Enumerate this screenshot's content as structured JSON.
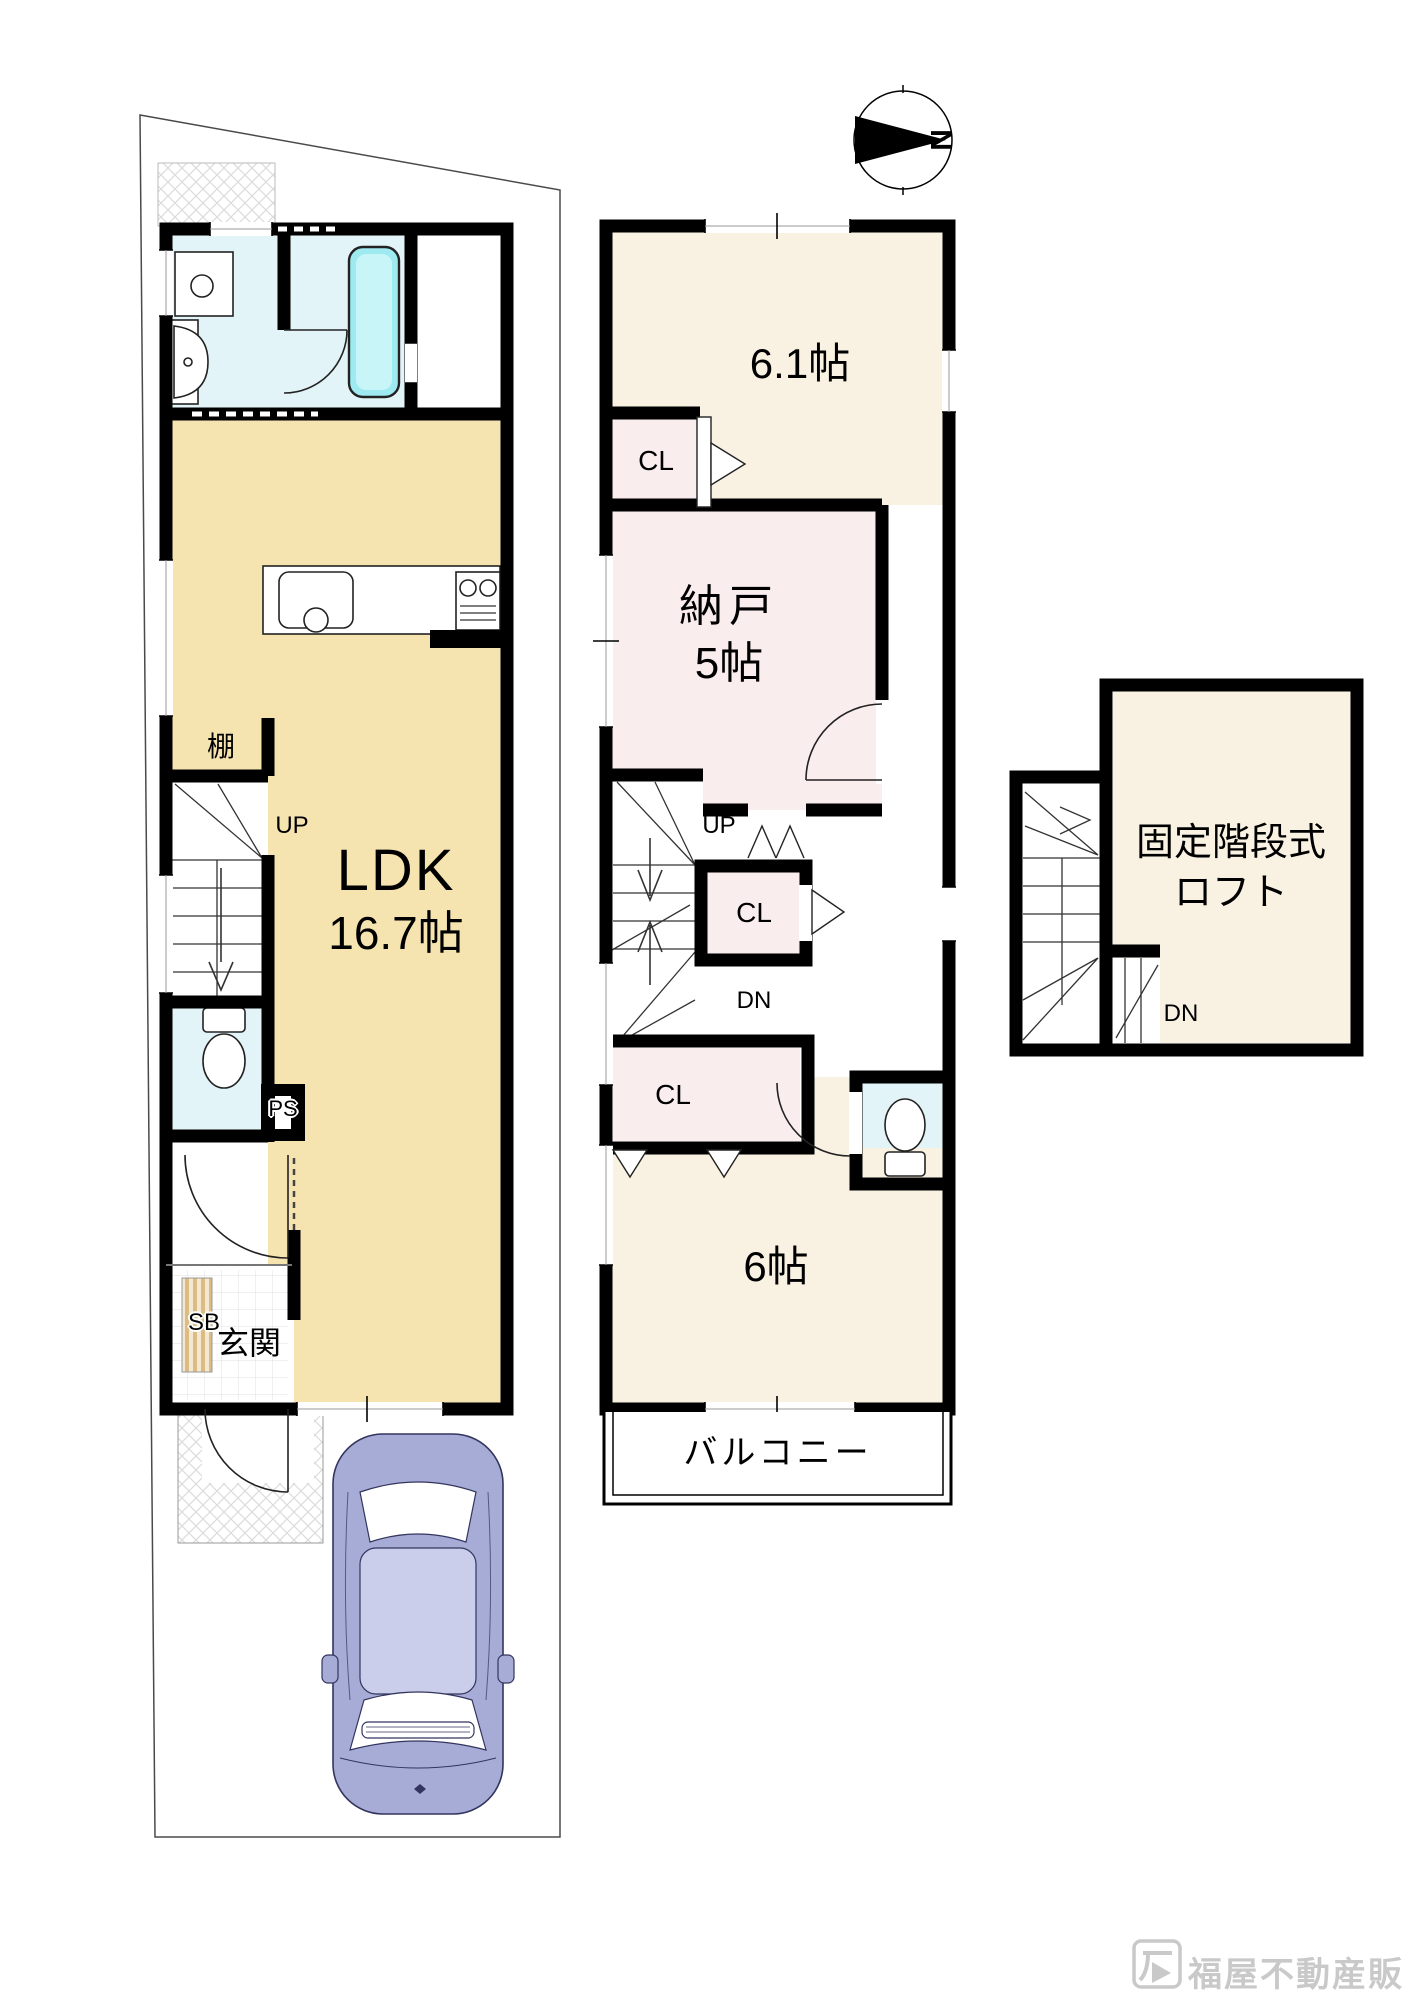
{
  "page": {
    "background": "#FFFFFF",
    "type": "floor-plan"
  },
  "compass": {
    "label": "N"
  },
  "floor1": {
    "rooms": {
      "ldk": {
        "label": "LDK",
        "size": "16.7帖"
      },
      "entrance": {
        "label": "玄関"
      },
      "shoe_box": {
        "label": "SB"
      },
      "pipe_space": {
        "label": "PS"
      },
      "shelf": {
        "label": "棚"
      },
      "stairs_up": {
        "label": "UP"
      }
    }
  },
  "floor2": {
    "rooms": {
      "room_6_1": {
        "label": "6.1帖"
      },
      "storage": {
        "label": "納戸",
        "size": "5帖"
      },
      "room_6": {
        "label": "6帖"
      },
      "balcony": {
        "label": "バルコニー"
      },
      "stairs_up": {
        "label": "UP"
      },
      "stairs_down": {
        "label": "DN"
      }
    },
    "closets": [
      "CL",
      "CL",
      "CL"
    ]
  },
  "loft": {
    "name_line1": "固定階段式",
    "name_line2": "ロフト",
    "stairs_down": {
      "label": "DN"
    }
  },
  "watermark": {
    "brand": "福屋不動産販売"
  },
  "colors": {
    "ldk": "#F5E3B0",
    "cream": "#F9F2E2",
    "pink": "#FAEDEE",
    "wet": "#E3F4F8",
    "tub": "#9FE9F0",
    "wall": "#000000",
    "car": "#A7ACD6",
    "stripe": "#DCBC82",
    "watermark": "#C9C9C9"
  }
}
